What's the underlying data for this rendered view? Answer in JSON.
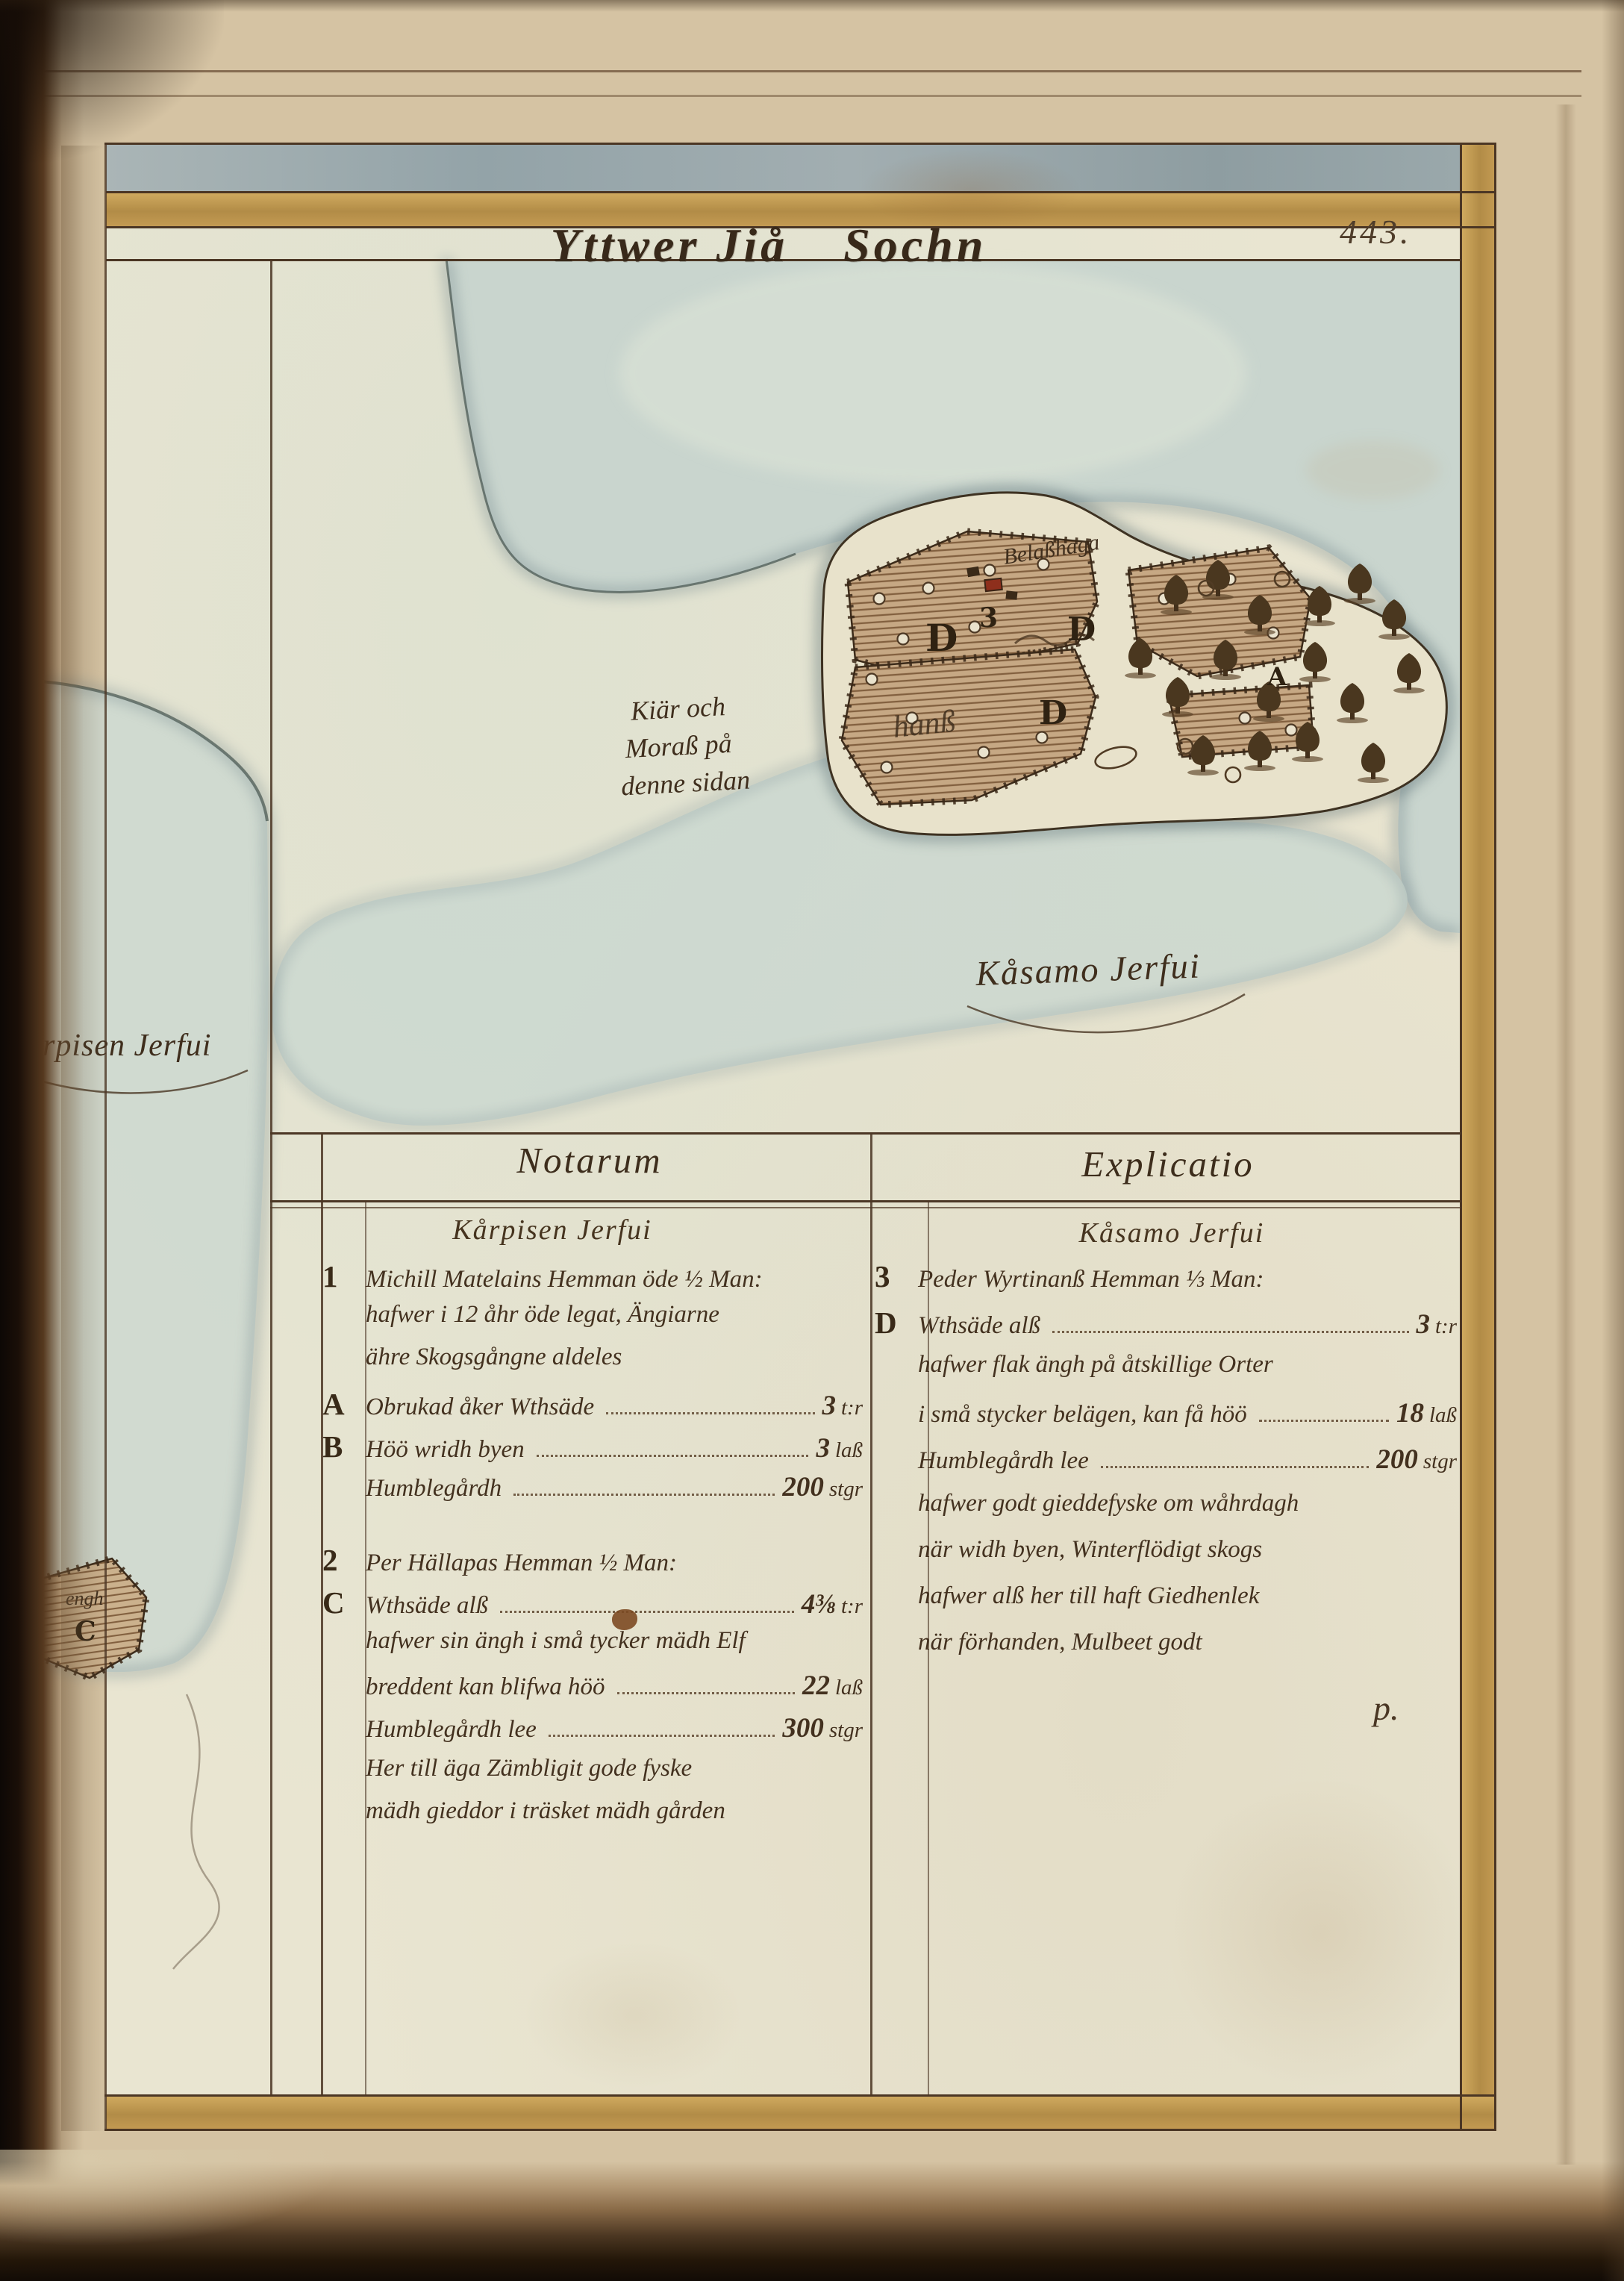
{
  "page": {
    "folio": "443.",
    "title": {
      "left": "Yttwer Jiå",
      "right": "Sochn"
    }
  },
  "map": {
    "marsh_note": {
      "l1": "Kiär och",
      "l2": "Moraß på",
      "l3": "denne sidan"
    },
    "lake_south_label": "Kåsamo Jerfui",
    "lake_west_label": "Korpisen Jerfui",
    "hage_label": "Belaßhaga",
    "west_field_label": "hanß",
    "parcel_number": "3",
    "field_letter": "D",
    "tree_area_letter": "A",
    "enclosure_letter": "C",
    "enclosure_label": "engh"
  },
  "table": {
    "left_header": "Notarum",
    "right_header": "Explicatio",
    "left_subheader": "Kårpisen Jerfui",
    "right_subheader": "Kåsamo Jerfui",
    "left_rows": [
      {
        "m": "1",
        "t": "Michill Matelains Hemman öde ½ Man:"
      },
      {
        "t": "hafwer i 12 åhr öde legat, Ängiarne"
      },
      {
        "t": "ähre Skogsgångne aldeles"
      },
      {
        "m": "A",
        "t": "Obrukad åker Wthsäde",
        "v": "3",
        "u": "t:r"
      },
      {
        "m": "B",
        "t": "Höö wridh byen",
        "v": "3",
        "u": "laß"
      },
      {
        "t": "Humblegårdh",
        "v": "200",
        "u": "stgr"
      },
      {
        "m": "2",
        "t": "Per Hällapas Hemman ½ Man:",
        "gap": true
      },
      {
        "m": "C",
        "t": "Wthsäde alß",
        "v": "4⅜",
        "u": "t:r"
      },
      {
        "t": "hafwer sin ängh i små tycker mädh Elf"
      },
      {
        "t": "breddent kan blifwa höö",
        "v": "22",
        "u": "laß"
      },
      {
        "t": "Humblegårdh lee",
        "v": "300",
        "u": "stgr"
      },
      {
        "t": "Her till äga Zämbligit gode fyske"
      },
      {
        "t": "mädh gieddor i träsket mädh gården"
      }
    ],
    "right_rows": [
      {
        "m": "3",
        "t": "Peder Wyrtinanß Hemman ⅓ Man:"
      },
      {
        "m": "D",
        "t": "Wthsäde alß",
        "v": "3",
        "u": "t:r"
      },
      {
        "t": "hafwer flak ängh på åtskillige Orter"
      },
      {
        "t": "i små stycker belägen, kan få höö",
        "v": "18",
        "u": "laß"
      },
      {
        "t": "Humblegårdh lee",
        "v": "200",
        "u": "stgr"
      },
      {
        "t": "hafwer godt gieddefyske om wåhrdagh"
      },
      {
        "t": "när widh byen, Winterflödigt skogs"
      },
      {
        "t": "hafwer alß her till haft Giedhenlek"
      },
      {
        "t": "när förhanden, Mulbeet godt"
      }
    ],
    "right_flourish": "p."
  }
}
